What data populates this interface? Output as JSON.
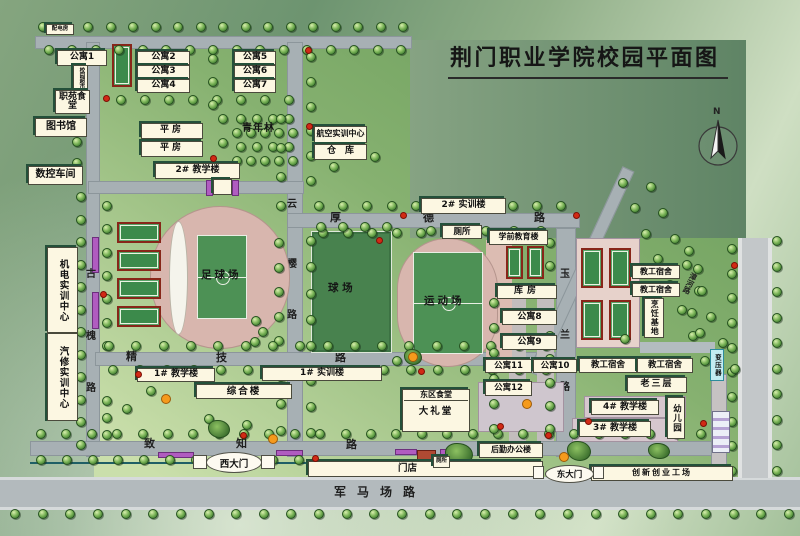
{
  "title": "荆门职业学院校园平面图",
  "compass": {
    "label": "N"
  },
  "colors": {
    "campus_green": "#7fae6a",
    "road_gray": "#a7b0b4",
    "building_cream": "#fcf7e2",
    "building_shadow_green": "#24503a",
    "court_green": "#3c8a4b",
    "court_border_red": "#872619",
    "track_pink": "#d8b6ae",
    "transformer_cyan": "#c2ecf2",
    "flowerbed_purple": "#b05cc0"
  },
  "roads": {
    "guhuai": "古槐路",
    "yunying": "云樱路",
    "houde": "厚德路",
    "jingji": "精技路",
    "yulan": "玉兰路",
    "zhizhi": "致知路",
    "junmachang": "军马场路",
    "zhanghe": "漳河路"
  },
  "gates": {
    "west": "西大门",
    "east": "东大门"
  },
  "areas": {
    "zqc": "足球场",
    "qc": "球 场",
    "ydc": "运动场",
    "qnl": "青年林"
  },
  "b": {
    "pdf": "配电房",
    "gy1": "公寓1",
    "gy2": "公寓2",
    "gy3": "公寓3",
    "gy4": "公寓4",
    "gy5": "公寓5",
    "gy6": "公寓6",
    "gy7": "公寓7",
    "xycs": "校园超市",
    "zyst": "职苑食堂",
    "tsg": "图书馆",
    "skcj": "数控车间",
    "pf1": "平房",
    "pf2": "平房",
    "jxl2": "2# 教学楼",
    "hksx": "航空实训中心",
    "ck": "仓　库",
    "sxl2": "2# 实训楼",
    "cs1": "厕所",
    "xqjy": "学前教育楼",
    "kf": "库房",
    "gy8": "公寓8",
    "gy9": "公寓9",
    "gy10": "公寓10",
    "gy11": "公寓11",
    "gy12": "公寓12",
    "dqst": "东区食堂",
    "dlt": "大礼堂",
    "hqbg": "后勤办公楼",
    "md": "门店",
    "cs2": "厕所",
    "cxcy": "创新创业工场",
    "zhl": "综合楼",
    "jxl1": "1# 教学楼",
    "sxl1": "1# 实训楼",
    "jgss1": "教工宿舍",
    "jgss2": "教工宿舍",
    "jgss3": "教工宿舍",
    "jgss4": "教工宿舍",
    "prjd": "烹饪基地",
    "lsc": "老三层",
    "jxl4": "4# 教学楼",
    "jxl3": "3# 教学楼",
    "yey": "幼儿园",
    "byq": "变压器",
    "jdsx": "机电实训中心",
    "qxsx": "汽修实训中心"
  }
}
